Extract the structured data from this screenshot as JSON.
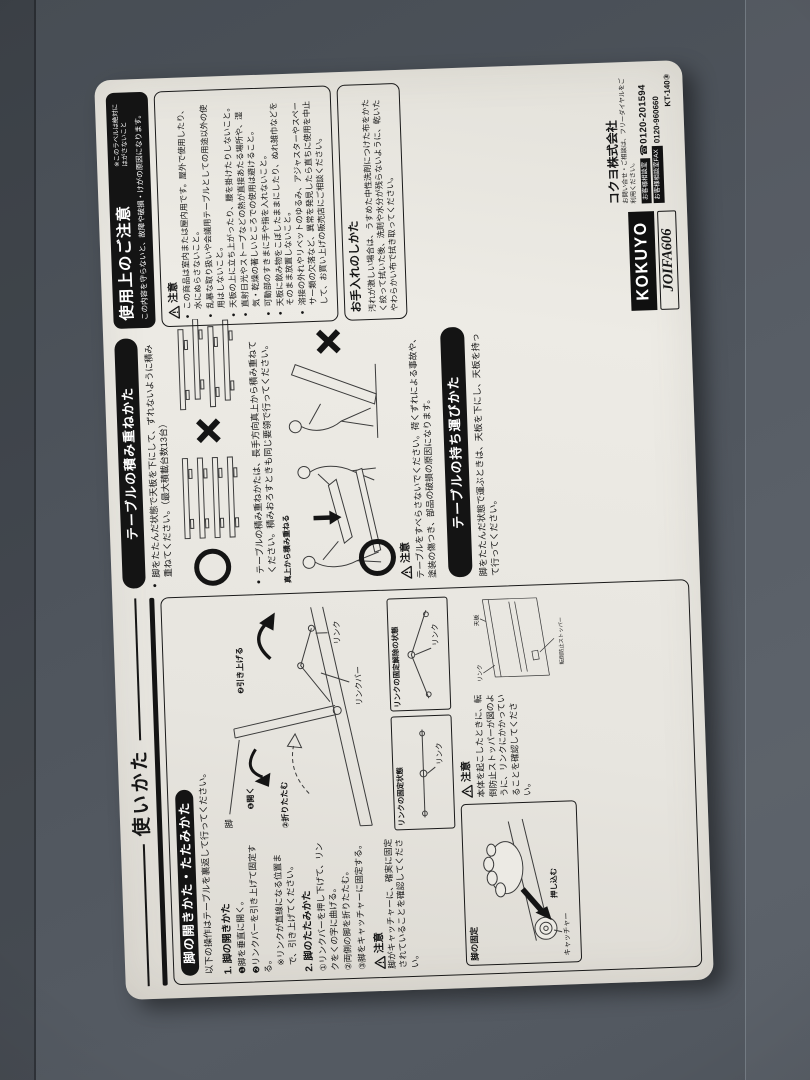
{
  "scene": {
    "background": "#4e545c",
    "label_bg": "#e8e6e0",
    "ink": "#161616"
  },
  "usage": {
    "title": "使いかた",
    "subheader": "脚の開きかた・たたみかた",
    "intro": "以下の操作はテーブルを裏返して行ってください。",
    "open_heading": "1. 脚の開きかた",
    "open_steps": [
      "❶脚を垂直に開く。",
      "❷リンクバーを引き上げて固定する。"
    ],
    "open_note": "※リンクが直線になる位置まで、引き上げてください。",
    "fold_heading": "2. 脚のたたみかた",
    "fold_steps": [
      "①リンクバーを押し下げて、リンクをくの字に曲げる。",
      "②両側の脚を折りたたむ。",
      "③脚をキャッチャーに固定する。"
    ],
    "caution_label": "注意",
    "caution_catcher": "脚がキャッチャーに、確実に固定されていることを確認してください。",
    "caution_stopper": "本体を起こしたときに、転倒防止ストッパーが図のように、リンクにかかっていることを確認してください。",
    "labels": {
      "leg": "脚",
      "tenban": "天板",
      "link_bar": "リンクバー",
      "link": "リンク",
      "open": "❶開く",
      "pull_up": "❷引き上げる",
      "fold": "②折りたたむ",
      "link_fixed": "リンクの固定状態",
      "link_released": "リンクの固定解除の状態",
      "stopper": "転倒防止ストッパー",
      "leg_fix": "脚の固定",
      "push": "押し込む",
      "catcher": "キャッチャー"
    }
  },
  "stacking": {
    "title": "テーブルの積み重ねかた",
    "bullet1": "脚をたたんだ状態で天板を下にして、ずれないように積み重ねてください。",
    "bullet1_note": "（最大積載台数13台）",
    "bullet2": "テーブルの積み重ねかたは、長手方向真上から積み重ねてください。積みおろすときも同じ要領で行ってください。",
    "annotation": "真上から積み重ねる",
    "caution_label": "注意",
    "caution": "テーブルをすべらさないでください。荷くずれによる事故や、塗装の傷つき、部品の破損の原因になります。"
  },
  "carrying": {
    "title": "テーブルの持ち運びかた",
    "text": "脚をたたんだ状態で運ぶときは、天板を下にし、天板を持って行ってください。"
  },
  "notice": {
    "title": "使用上のご注意",
    "peel_note": "※このラベルは絶対にはがさないこと",
    "subtitle": "この内容を守らないと、故障や破損・けがの原因になります。",
    "caution_label": "注意",
    "items": [
      "この商品は室内または屋内用です。屋外で使用したり、水にぬらさないこと。",
      "乱暴な取り扱いや会議用テーブルとしての用途以外の使用はしないこと。",
      "天板の上に立ち上がったり、腰を掛けたりしないこと。",
      "直射日光やストーブなどの熱が直接あたる場所や、湿気・乾燥の著しいところでの使用は避けること。",
      "可動部のすきまに手や指を入れないこと。",
      "天板に飲み物をこぼしたままにしたり、ぬれ雑巾などをそのまま放置しないこと。",
      "溶接の外れやリベットのゆるみ、アジャスターやスペーサー類の欠落など、異常を発見したら直ちに使用を中止して、お買い上げの販売店にご相談ください。"
    ]
  },
  "care": {
    "title": "お手入れのしかた",
    "text": "汚れが激しい場合は、うすめた中性洗剤につけた布をかたく絞って拭いた後、洗剤や水分が残らないように、乾いたやわらかい布で拭き取ってください。"
  },
  "branding": {
    "company": "コクヨ株式会社",
    "company_note": "お問い合せ・ご相談は、フリーダイヤルをご利用ください。",
    "support_label": "お客様相談室",
    "support_phone": "☎0120-201594",
    "fax_label": "お客様相談室FAX",
    "fax_number": "0120-960660",
    "model": "KT-140③",
    "logo": "KOKUYO",
    "joifa": "JOIFA606"
  }
}
